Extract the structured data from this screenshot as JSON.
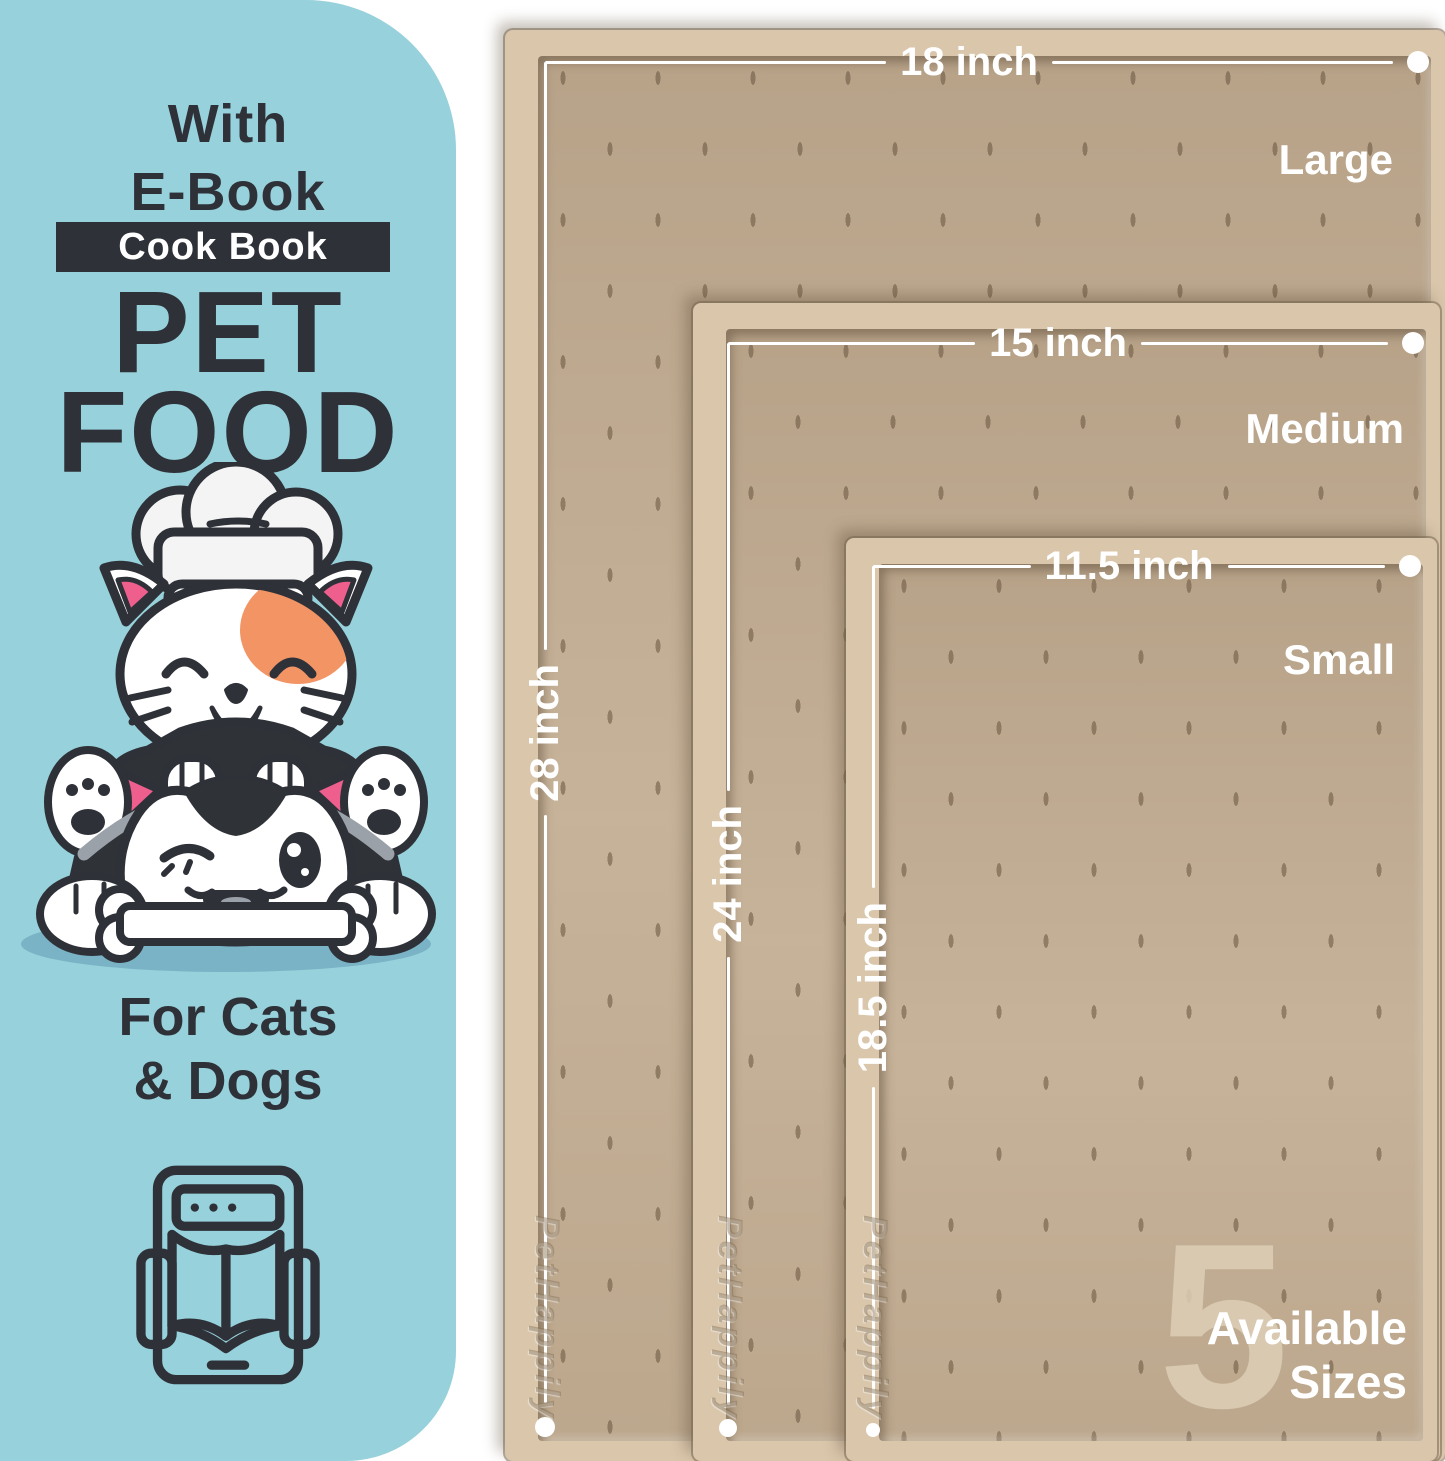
{
  "left_panel": {
    "heading_line1": "With",
    "heading_line2": "E-Book",
    "banner_label": "Cook Book",
    "title_line1": "PET",
    "title_line2": "FOOD",
    "audience_line1": "For Cats",
    "audience_line2": "& Dogs"
  },
  "mats": {
    "brand_embossed": "PetHappily",
    "items": [
      {
        "size_label": "Large",
        "width_label": "18 inch",
        "height_label": "28 inch"
      },
      {
        "size_label": "Medium",
        "width_label": "15 inch",
        "height_label": "24 inch"
      },
      {
        "size_label": "Small",
        "width_label": "11.5 inch",
        "height_label": "18.5 inch"
      }
    ],
    "availability": {
      "count": "5",
      "line1": "Available",
      "line2": "Sizes"
    }
  },
  "colors": {
    "panel_blue": "#97d1db",
    "ink_dark": "#2e3138",
    "mat_surface": "#c3ae93",
    "mat_rim": "#d9c6ab",
    "measure_white": "#ffffff",
    "cat_patch_orange": "#f29464",
    "ear_tongue_pink": "#ee5f8e"
  }
}
